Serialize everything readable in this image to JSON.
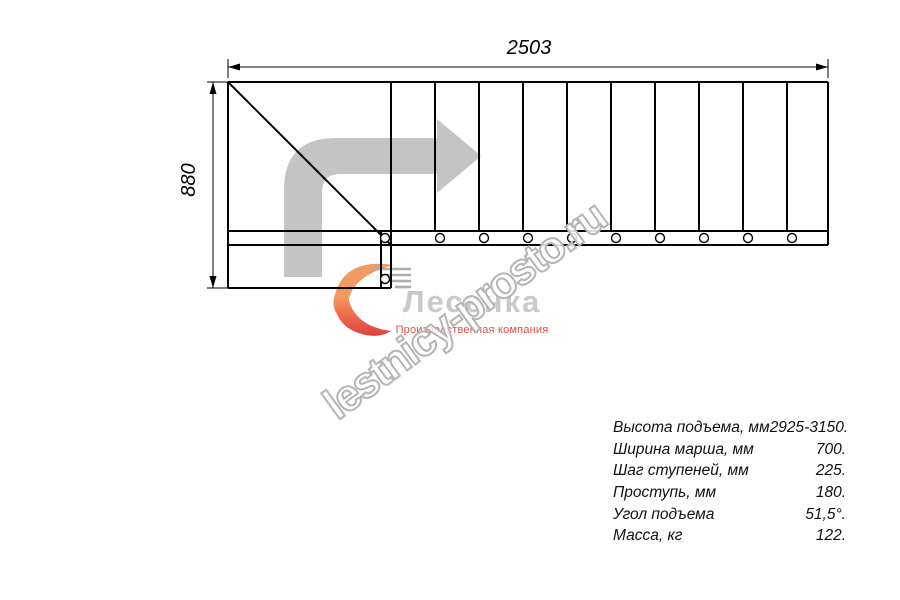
{
  "drawing": {
    "width_dimension": "2503",
    "height_dimension": "880",
    "step_count": 10,
    "icons": [
      "direction-arrow-icon",
      "flame-icon",
      "stairs-icon"
    ]
  },
  "watermark": {
    "text": "lestnicy-prosto.ru"
  },
  "logo": {
    "company": "Лесенка",
    "tagline": "Производственная компания"
  },
  "specs": {
    "rows": [
      {
        "label": "Высота подъема, мм",
        "value": "2925-3150."
      },
      {
        "label": "Ширина марша, мм",
        "value": "700."
      },
      {
        "label": "Шаг ступеней, мм",
        "value": "225."
      },
      {
        "label": "Проступь, мм",
        "value": "180."
      },
      {
        "label": "Угол подъема",
        "value": "51,5°."
      },
      {
        "label": "Масса, кг",
        "value": "122."
      }
    ]
  },
  "colors": {
    "line": "#000000",
    "direction_arrow": "#c4c4c4",
    "watermark_outline": "#b5b5b5",
    "logo_text": "#c9c9c9",
    "logo_tagline": "#e04f49",
    "flame_top": "#f19b63",
    "flame_bottom": "#e34941"
  }
}
